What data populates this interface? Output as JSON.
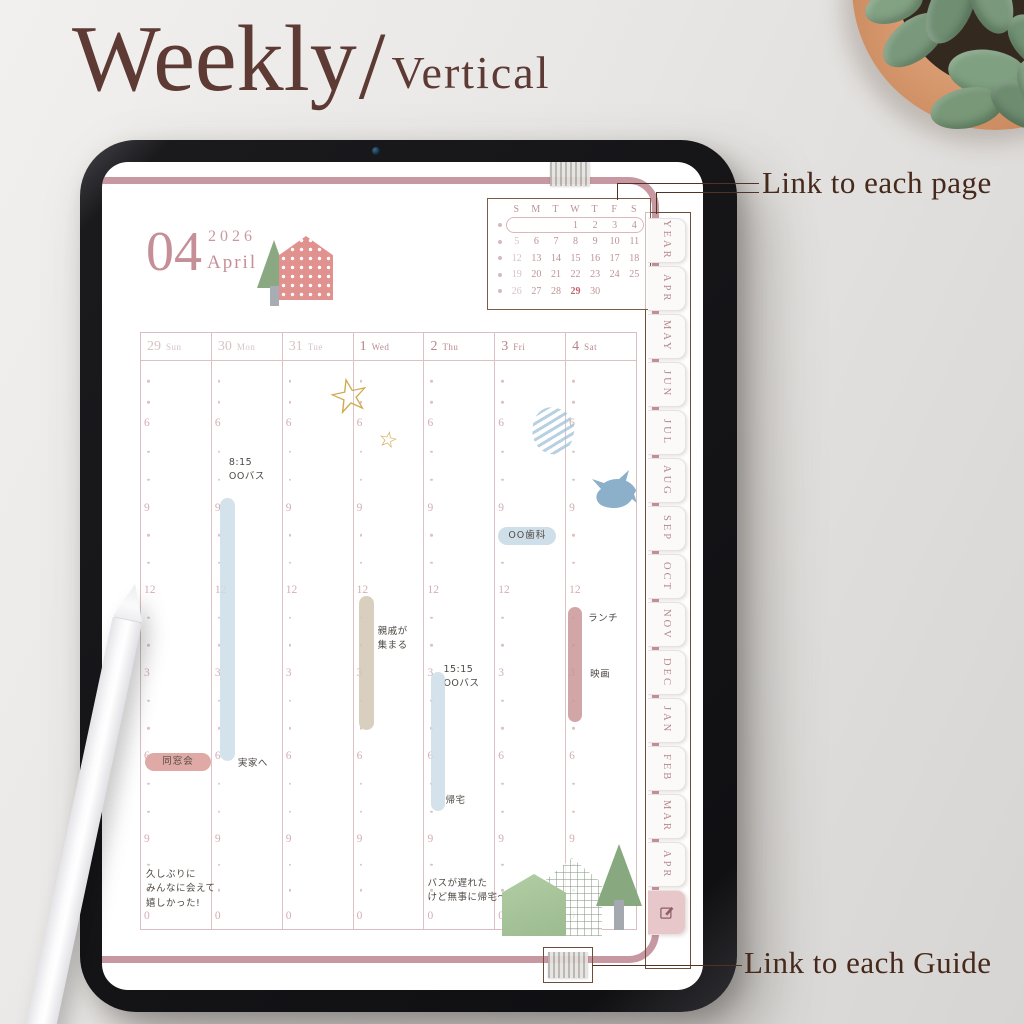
{
  "header": {
    "title_main": "Weekly",
    "title_separator": "/",
    "title_sub": "Vertical"
  },
  "annotations": {
    "link_pages": "Link to each page",
    "link_guides": "Link to each Guide"
  },
  "colors": {
    "accent_pink": "#c797a2",
    "title_brown": "#5d3a34",
    "annotation_brown": "#46291a",
    "tab_text": "#b2878c",
    "handwriting_ink": "#4e4a44",
    "bar_blue": "#ccdee8",
    "bar_tan": "#d2c7b4",
    "bar_pink": "#ca9598",
    "pill_pink": "#dfa9a6",
    "pill_blue": "#cfdfe9"
  },
  "planner": {
    "month_number": "04",
    "year": "2026",
    "month_name": "April",
    "mini_calendar": {
      "day_headers": [
        "S",
        "M",
        "T",
        "W",
        "T",
        "F",
        "S"
      ],
      "weeks": [
        [
          "",
          "",
          "",
          "1",
          "2",
          "3",
          "4"
        ],
        [
          "5",
          "6",
          "7",
          "8",
          "9",
          "10",
          "11"
        ],
        [
          "12",
          "13",
          "14",
          "15",
          "16",
          "17",
          "18"
        ],
        [
          "19",
          "20",
          "21",
          "22",
          "23",
          "24",
          "25"
        ],
        [
          "26",
          "27",
          "28",
          "29",
          "30",
          "",
          ""
        ]
      ],
      "highlighted_week_index": 0,
      "accent_date": "29"
    },
    "time_labels": [
      "6",
      "9",
      "12",
      "3",
      "6",
      "9",
      "0"
    ],
    "columns": [
      {
        "date": "29",
        "day": "Sun",
        "current": false,
        "events": [
          {
            "type": "pill",
            "label": "同窓会",
            "bg": "#dfa9a6",
            "top": 69.1,
            "left": 4,
            "width": 66
          },
          {
            "type": "text",
            "lines": [
              "久しぶりに",
              "みんなに会えて",
              "嬉しかった!"
            ],
            "top": 89.3,
            "left": 5
          }
        ]
      },
      {
        "date": "30",
        "day": "Mon",
        "current": false,
        "events": [
          {
            "type": "text",
            "lines": [
              "8:15",
              "OOバス"
            ],
            "top": 16.7,
            "left": 17
          },
          {
            "type": "bar",
            "bg": "#ccdee8",
            "top": 24.2,
            "height": 46.3,
            "left": 8,
            "width": 15
          },
          {
            "type": "text",
            "lines": [
              "実家へ"
            ],
            "top": 69.8,
            "left": 26
          }
        ]
      },
      {
        "date": "31",
        "day": "Tue",
        "current": false,
        "events": []
      },
      {
        "date": "1",
        "day": "Wed",
        "current": true,
        "events": [
          {
            "type": "bar",
            "bg": "#d2c7b4",
            "top": 41.4,
            "height": 23.5,
            "left": 5,
            "width": 15
          },
          {
            "type": "text",
            "lines": [
              "親戚が",
              "集まる"
            ],
            "top": 46.5,
            "left": 24
          }
        ]
      },
      {
        "date": "2",
        "day": "Thu",
        "current": true,
        "events": [
          {
            "type": "text",
            "lines": [
              "15:15",
              "OOバス"
            ],
            "top": 53.2,
            "left": 19
          },
          {
            "type": "bar",
            "bg": "#ccdee8",
            "top": 54.7,
            "height": 24.6,
            "left": 7,
            "width": 14
          },
          {
            "type": "text",
            "lines": [
              "帰宅"
            ],
            "top": 76.3,
            "left": 21
          },
          {
            "type": "text",
            "lines": [
              "バスが遅れた",
              "けど無事に帰宅〜"
            ],
            "top": 90.8,
            "left": 3
          }
        ]
      },
      {
        "date": "3",
        "day": "Fri",
        "current": true,
        "events": [
          {
            "type": "pill",
            "label": "OO歯科",
            "bg": "#cfdfe9",
            "top": 29.3,
            "left": 3,
            "width": 58
          }
        ]
      },
      {
        "date": "4",
        "day": "Sat",
        "current": true,
        "events": [
          {
            "type": "bar",
            "bg": "#ca9598",
            "top": 43.3,
            "height": 20.2,
            "left": 2,
            "width": 14
          },
          {
            "type": "text",
            "lines": [
              "ランチ"
            ],
            "top": 44.2,
            "left": 22
          },
          {
            "type": "text",
            "lines": [
              "映画"
            ],
            "top": 54.0,
            "left": 24
          }
        ]
      }
    ],
    "tabs": [
      "YEAR",
      "APR",
      "MAY",
      "JUN",
      "JUL",
      "AUG",
      "SEP",
      "OCT",
      "NOV",
      "DEC",
      "JAN",
      "FEB",
      "MAR",
      "APR"
    ],
    "edit_tab_icon": "edit-pencil"
  }
}
